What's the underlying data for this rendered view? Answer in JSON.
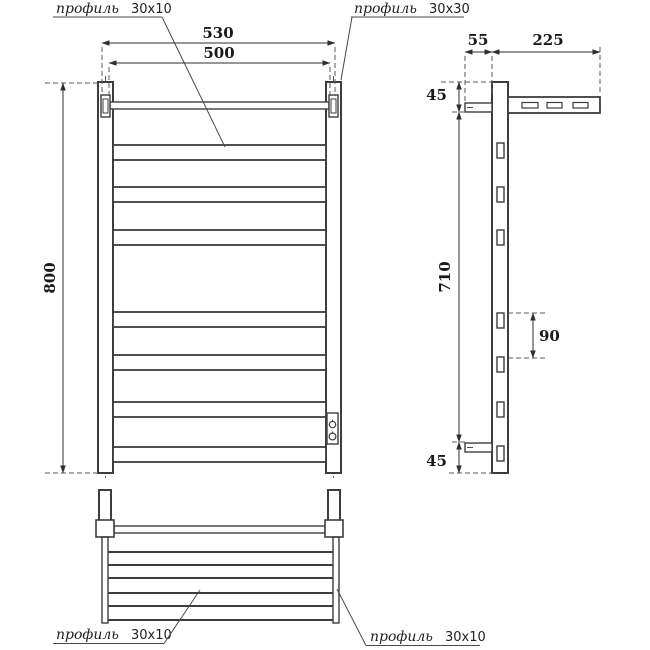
{
  "drawing": {
    "front_view": {
      "dim_width_outer": "530",
      "dim_width_inner": "500",
      "dim_height": "800",
      "label_rail_profile": {
        "name": "профиль",
        "size": "30x10"
      },
      "label_post_profile": {
        "name": "профиль",
        "size": "30x30"
      }
    },
    "side_view": {
      "dim_bracket_depth": "55",
      "dim_shelf_depth": "225",
      "dim_top_offset": "45",
      "dim_mount_height": "710",
      "dim_rail_spacing": "90",
      "dim_bottom_offset": "45"
    },
    "top_view": {
      "label_rail_profile_left": {
        "name": "профиль",
        "size": "30x10"
      },
      "label_rail_profile_right": {
        "name": "профиль",
        "size": "30x10"
      }
    },
    "colors": {
      "line": "#3d3d3d",
      "text": "#1a1a1a",
      "background": "#ffffff"
    }
  }
}
